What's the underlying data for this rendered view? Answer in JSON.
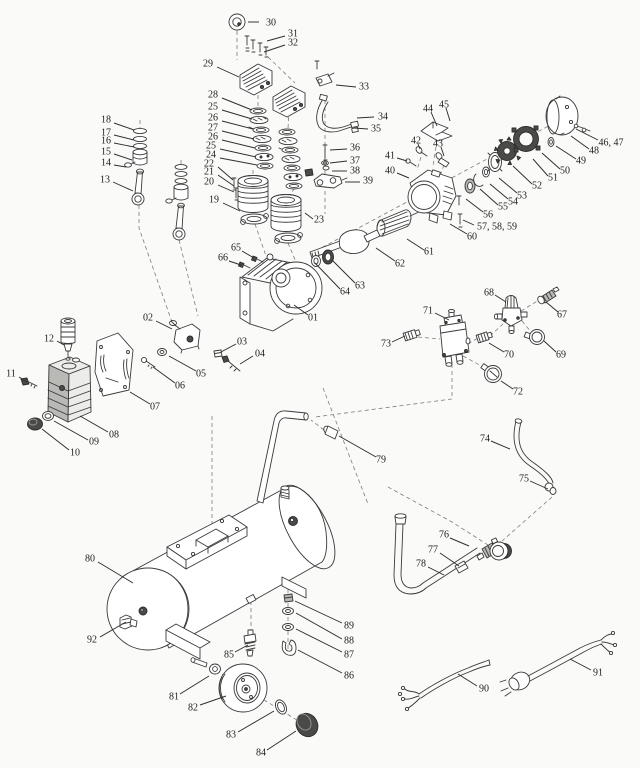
{
  "figure": {
    "type": "exploded-parts-diagram",
    "subject": "Air compressor exploded parts view",
    "background": "#fafaf8",
    "ink": "#3a3a3a",
    "label_color": "#1c1c1c",
    "label_font_px": 10
  },
  "labels": [
    {
      "t": "30",
      "x": 271,
      "y": 23,
      "l": [
        259,
        22,
        248,
        22
      ]
    },
    {
      "t": "31",
      "x": 293,
      "y": 34,
      "l": [
        285,
        36,
        267,
        41
      ]
    },
    {
      "t": "32",
      "x": 293,
      "y": 43,
      "l": [
        285,
        45,
        264,
        52
      ]
    },
    {
      "t": "29",
      "x": 208,
      "y": 64,
      "l": [
        217,
        67,
        239,
        77
      ]
    },
    {
      "t": "28",
      "x": 213,
      "y": 95,
      "l": [
        222,
        98,
        252,
        110
      ]
    },
    {
      "t": "25",
      "x": 213,
      "y": 107,
      "l": [
        222,
        110,
        252,
        119
      ]
    },
    {
      "t": "26",
      "x": 213,
      "y": 118,
      "l": [
        222,
        121,
        253,
        129
      ]
    },
    {
      "t": "27",
      "x": 213,
      "y": 128,
      "l": [
        222,
        131,
        254,
        139
      ]
    },
    {
      "t": "26",
      "x": 213,
      "y": 137,
      "l": [
        222,
        140,
        255,
        148
      ]
    },
    {
      "t": "25",
      "x": 211,
      "y": 146,
      "l": [
        220,
        149,
        256,
        157
      ]
    },
    {
      "t": "24",
      "x": 211,
      "y": 155,
      "l": [
        220,
        158,
        257,
        165
      ]
    },
    {
      "t": "22",
      "x": 209,
      "y": 164,
      "l": [
        218,
        167,
        233,
        180
      ]
    },
    {
      "t": "21",
      "x": 209,
      "y": 172,
      "l": [
        218,
        175,
        234,
        186
      ]
    },
    {
      "t": "20",
      "x": 209,
      "y": 182,
      "l": [
        218,
        185,
        234,
        192
      ]
    },
    {
      "t": "19",
      "x": 214,
      "y": 200,
      "l": [
        223,
        203,
        240,
        211
      ]
    },
    {
      "t": "23",
      "x": 319,
      "y": 220,
      "l": [
        313,
        219,
        305,
        213
      ]
    },
    {
      "t": "18",
      "x": 106,
      "y": 120,
      "l": [
        114,
        123,
        134,
        130
      ]
    },
    {
      "t": "17",
      "x": 106,
      "y": 133,
      "l": [
        114,
        135,
        134,
        140
      ]
    },
    {
      "t": "16",
      "x": 106,
      "y": 141,
      "l": [
        114,
        143,
        134,
        147
      ]
    },
    {
      "t": "15",
      "x": 106,
      "y": 152,
      "l": [
        114,
        154,
        132,
        160
      ]
    },
    {
      "t": "14",
      "x": 106,
      "y": 163,
      "l": [
        114,
        165,
        126,
        167
      ]
    },
    {
      "t": "13",
      "x": 105,
      "y": 180,
      "l": [
        113,
        182,
        133,
        191
      ]
    },
    {
      "t": "33",
      "x": 364,
      "y": 87,
      "l": [
        356,
        87,
        336,
        85
      ]
    },
    {
      "t": "34",
      "x": 383,
      "y": 117,
      "l": [
        374,
        117,
        357,
        118
      ]
    },
    {
      "t": "35",
      "x": 376,
      "y": 129,
      "l": [
        368,
        129,
        354,
        128
      ]
    },
    {
      "t": "36",
      "x": 355,
      "y": 148,
      "l": [
        347,
        149,
        330,
        150
      ]
    },
    {
      "t": "37",
      "x": 355,
      "y": 161,
      "l": [
        347,
        161,
        330,
        163
      ]
    },
    {
      "t": "38",
      "x": 355,
      "y": 171,
      "l": [
        347,
        171,
        332,
        171
      ]
    },
    {
      "t": "39",
      "x": 368,
      "y": 181,
      "l": [
        360,
        182,
        345,
        182
      ]
    },
    {
      "t": "44",
      "x": 428,
      "y": 109,
      "l": [
        431,
        112,
        437,
        126
      ]
    },
    {
      "t": "45",
      "x": 444,
      "y": 105,
      "l": [
        446,
        108,
        450,
        121
      ]
    },
    {
      "t": "42",
      "x": 416,
      "y": 141,
      "l": [
        418,
        144,
        420,
        149
      ]
    },
    {
      "t": "43",
      "x": 438,
      "y": 144,
      "l": [
        441,
        147,
        444,
        156
      ]
    },
    {
      "t": "41",
      "x": 390,
      "y": 156,
      "l": [
        397,
        158,
        407,
        161
      ]
    },
    {
      "t": "40",
      "x": 390,
      "y": 171,
      "l": [
        397,
        173,
        409,
        178
      ]
    },
    {
      "t": "46, 47",
      "x": 611,
      "y": 143,
      "l": [
        598,
        140,
        576,
        129
      ]
    },
    {
      "t": "48",
      "x": 594,
      "y": 151,
      "l": [
        589,
        149,
        571,
        136
      ]
    },
    {
      "t": "49",
      "x": 581,
      "y": 161,
      "l": [
        576,
        159,
        556,
        146
      ]
    },
    {
      "t": "50",
      "x": 565,
      "y": 171,
      "l": [
        560,
        169,
        542,
        153
      ]
    },
    {
      "t": "51",
      "x": 553,
      "y": 178,
      "l": [
        548,
        176,
        533,
        159
      ]
    },
    {
      "t": "52",
      "x": 537,
      "y": 186,
      "l": [
        532,
        184,
        513,
        166
      ]
    },
    {
      "t": "53",
      "x": 522,
      "y": 196,
      "l": [
        517,
        193,
        499,
        178
      ]
    },
    {
      "t": "54",
      "x": 513,
      "y": 202,
      "l": [
        508,
        199,
        490,
        184
      ]
    },
    {
      "t": "55",
      "x": 503,
      "y": 207,
      "l": [
        498,
        205,
        480,
        189
      ]
    },
    {
      "t": "56",
      "x": 488,
      "y": 215,
      "l": [
        483,
        212,
        466,
        199
      ]
    },
    {
      "t": "57, 58, 59",
      "x": 497,
      "y": 227,
      "l": [
        474,
        225,
        463,
        220
      ]
    },
    {
      "t": "60",
      "x": 472,
      "y": 237,
      "l": [
        467,
        234,
        450,
        224
      ]
    },
    {
      "t": "61",
      "x": 429,
      "y": 252,
      "l": [
        424,
        250,
        407,
        239
      ]
    },
    {
      "t": "62",
      "x": 400,
      "y": 264,
      "l": [
        395,
        261,
        376,
        248
      ]
    },
    {
      "t": "63",
      "x": 360,
      "y": 286,
      "l": [
        355,
        283,
        332,
        260
      ]
    },
    {
      "t": "64",
      "x": 345,
      "y": 292,
      "l": [
        340,
        289,
        315,
        263
      ]
    },
    {
      "t": "01",
      "x": 313,
      "y": 318,
      "l": [
        308,
        315,
        294,
        305
      ]
    },
    {
      "t": "65",
      "x": 236,
      "y": 248,
      "l": [
        242,
        251,
        254,
        258
      ]
    },
    {
      "t": "66",
      "x": 223,
      "y": 258,
      "l": [
        229,
        261,
        241,
        265
      ]
    },
    {
      "t": "02",
      "x": 148,
      "y": 318,
      "l": [
        156,
        321,
        172,
        329
      ]
    },
    {
      "t": "03",
      "x": 242,
      "y": 342,
      "l": [
        236,
        344,
        221,
        352
      ]
    },
    {
      "t": "04",
      "x": 260,
      "y": 354,
      "l": [
        253,
        356,
        240,
        364
      ]
    },
    {
      "t": "05",
      "x": 201,
      "y": 374,
      "l": [
        196,
        371,
        169,
        356
      ]
    },
    {
      "t": "06",
      "x": 180,
      "y": 386,
      "l": [
        175,
        383,
        153,
        367
      ]
    },
    {
      "t": "07",
      "x": 155,
      "y": 407,
      "l": [
        150,
        404,
        130,
        392
      ]
    },
    {
      "t": "08",
      "x": 114,
      "y": 435,
      "l": [
        108,
        432,
        80,
        416
      ]
    },
    {
      "t": "09",
      "x": 94,
      "y": 442,
      "l": [
        88,
        440,
        54,
        421
      ]
    },
    {
      "t": "10",
      "x": 75,
      "y": 453,
      "l": [
        69,
        450,
        42,
        429
      ]
    },
    {
      "t": "11",
      "x": 11,
      "y": 374,
      "l": [
        19,
        377,
        27,
        382
      ]
    },
    {
      "t": "12",
      "x": 49,
      "y": 339,
      "l": [
        57,
        341,
        64,
        345
      ]
    },
    {
      "t": "71",
      "x": 428,
      "y": 311,
      "l": [
        435,
        313,
        449,
        320
      ]
    },
    {
      "t": "73",
      "x": 386,
      "y": 344,
      "l": [
        392,
        342,
        405,
        336
      ]
    },
    {
      "t": "70",
      "x": 509,
      "y": 355,
      "l": [
        504,
        352,
        489,
        343
      ]
    },
    {
      "t": "68",
      "x": 489,
      "y": 293,
      "l": [
        495,
        295,
        506,
        302
      ]
    },
    {
      "t": "67",
      "x": 562,
      "y": 315,
      "l": [
        558,
        312,
        546,
        302
      ]
    },
    {
      "t": "69",
      "x": 561,
      "y": 355,
      "l": [
        556,
        352,
        544,
        341
      ]
    },
    {
      "t": "72",
      "x": 518,
      "y": 392,
      "l": [
        513,
        389,
        501,
        381
      ]
    },
    {
      "t": "79",
      "x": 381,
      "y": 460,
      "l": [
        376,
        457,
        339,
        436
      ]
    },
    {
      "t": "74",
      "x": 485,
      "y": 439,
      "l": [
        491,
        441,
        510,
        449
      ]
    },
    {
      "t": "75",
      "x": 524,
      "y": 479,
      "l": [
        530,
        481,
        548,
        489
      ]
    },
    {
      "t": "80",
      "x": 90,
      "y": 559,
      "l": [
        98,
        562,
        133,
        583
      ]
    },
    {
      "t": "92",
      "x": 92,
      "y": 640,
      "l": [
        100,
        637,
        126,
        622
      ]
    },
    {
      "t": "85",
      "x": 229,
      "y": 655,
      "l": [
        235,
        652,
        248,
        645
      ]
    },
    {
      "t": "81",
      "x": 174,
      "y": 697,
      "l": [
        180,
        694,
        209,
        676
      ]
    },
    {
      "t": "82",
      "x": 193,
      "y": 708,
      "l": [
        200,
        705,
        226,
        696
      ]
    },
    {
      "t": "83",
      "x": 231,
      "y": 735,
      "l": [
        238,
        732,
        274,
        711
      ]
    },
    {
      "t": "84",
      "x": 261,
      "y": 753,
      "l": [
        267,
        750,
        296,
        731
      ]
    },
    {
      "t": "76",
      "x": 444,
      "y": 535,
      "l": [
        450,
        538,
        469,
        546
      ]
    },
    {
      "t": "77",
      "x": 433,
      "y": 550,
      "l": [
        440,
        553,
        459,
        566
      ]
    },
    {
      "t": "78",
      "x": 421,
      "y": 564,
      "l": [
        428,
        567,
        444,
        575
      ]
    },
    {
      "t": "89",
      "x": 349,
      "y": 626,
      "l": [
        342,
        623,
        295,
        601
      ]
    },
    {
      "t": "88",
      "x": 349,
      "y": 641,
      "l": [
        342,
        639,
        296,
        613
      ]
    },
    {
      "t": "87",
      "x": 349,
      "y": 655,
      "l": [
        342,
        652,
        296,
        629
      ]
    },
    {
      "t": "86",
      "x": 349,
      "y": 676,
      "l": [
        342,
        673,
        298,
        650
      ]
    },
    {
      "t": "90",
      "x": 484,
      "y": 689,
      "l": [
        477,
        686,
        458,
        674
      ]
    },
    {
      "t": "91",
      "x": 598,
      "y": 673,
      "l": [
        591,
        670,
        570,
        659
      ]
    }
  ]
}
